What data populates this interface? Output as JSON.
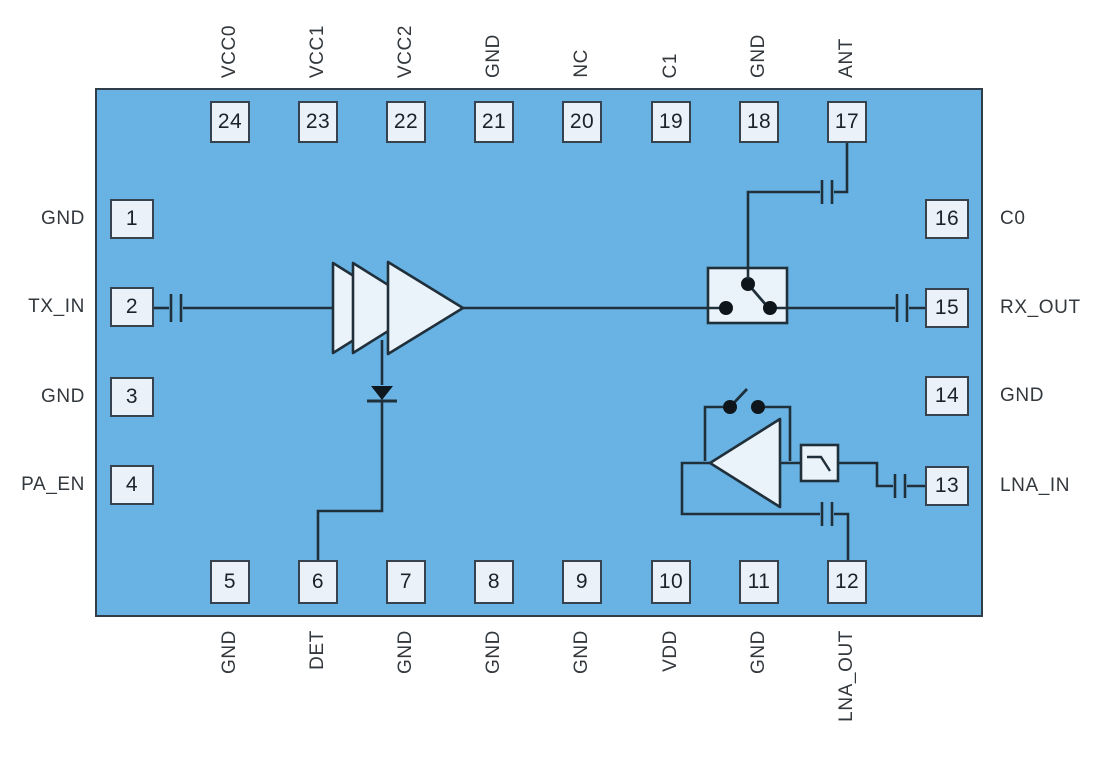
{
  "diagram_type": "rf-front-end-chip-pinout-functional-diagram",
  "colors": {
    "chip_fill": "#68B3E4",
    "chip_border": "#2F3E49",
    "pin_fill": "#EAF1F9",
    "pin_border": "#36434E",
    "wire": "#20303B",
    "label_text": "#33383D",
    "pin_number_text": "#1A232B",
    "symbol_fill": "#EAF2FA",
    "dot_fill": "#0E161C"
  },
  "chip": {
    "pins_top": [
      {
        "number": "24",
        "label": "VCC0"
      },
      {
        "number": "23",
        "label": "VCC1"
      },
      {
        "number": "22",
        "label": "VCC2"
      },
      {
        "number": "21",
        "label": "GND"
      },
      {
        "number": "20",
        "label": "NC"
      },
      {
        "number": "19",
        "label": "C1"
      },
      {
        "number": "18",
        "label": "GND"
      },
      {
        "number": "17",
        "label": "ANT"
      }
    ],
    "pins_bottom": [
      {
        "number": "5",
        "label": "GND"
      },
      {
        "number": "6",
        "label": "DET"
      },
      {
        "number": "7",
        "label": "GND"
      },
      {
        "number": "8",
        "label": "GND"
      },
      {
        "number": "9",
        "label": "GND"
      },
      {
        "number": "10",
        "label": "VDD"
      },
      {
        "number": "11",
        "label": "GND"
      },
      {
        "number": "12",
        "label": "LNA_OUT"
      }
    ],
    "pins_left": [
      {
        "number": "1",
        "label": "GND"
      },
      {
        "number": "2",
        "label": "TX_IN"
      },
      {
        "number": "3",
        "label": "GND"
      },
      {
        "number": "4",
        "label": "PA_EN"
      }
    ],
    "pins_right": [
      {
        "number": "16",
        "label": "C0"
      },
      {
        "number": "15",
        "label": "RX_OUT"
      },
      {
        "number": "14",
        "label": "GND"
      },
      {
        "number": "13",
        "label": "LNA_IN"
      }
    ],
    "blocks": {
      "tx_amplifier": "3-stage power amplifier",
      "detector_diode": "power detector to DET pin",
      "antenna_switch": "SPDT TX/RX switch",
      "lna": "low noise amplifier with bypass switch",
      "filter": "low-pass filter"
    }
  }
}
